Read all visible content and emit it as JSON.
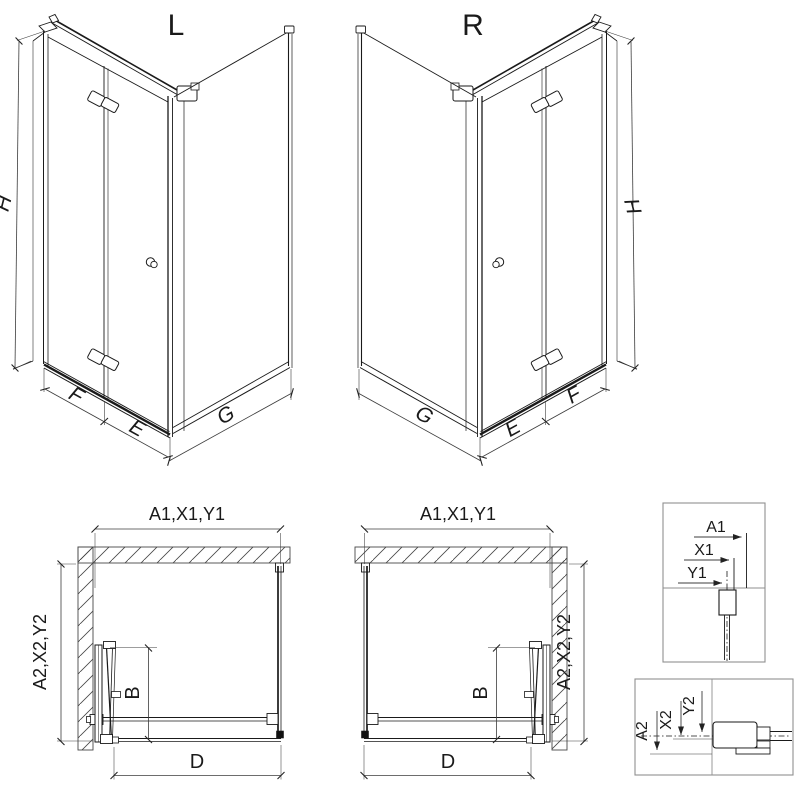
{
  "figures": {
    "iso_left": {
      "title": "L",
      "dim_height": "H",
      "dim_door_wall_segment": "F",
      "dim_door_corner_segment": "E",
      "dim_side_panel": "G"
    },
    "iso_right": {
      "title": "R",
      "dim_height": "H",
      "dim_door_wall_segment": "F",
      "dim_door_corner_segment": "E",
      "dim_side_panel": "G"
    },
    "plan_left": {
      "dim_top_width": "A1,X1,Y1",
      "dim_side_depth": "A2,X2,Y2",
      "dim_door_projection": "B",
      "dim_entry_width": "D"
    },
    "plan_right": {
      "dim_top_width": "A1,X1,Y1",
      "dim_side_depth": "A2,X2,Y2",
      "dim_door_projection": "B",
      "dim_entry_width": "D"
    },
    "detail_top": {
      "dim_a": "A1",
      "dim_x": "X1",
      "dim_y": "Y1"
    },
    "detail_bottom": {
      "dim_a": "A2",
      "dim_x": "X2",
      "dim_y": "Y2"
    }
  },
  "colors": {
    "line": "#1a1a1a",
    "dimension_line": "#3c3c3c",
    "hatch": "#474747",
    "detail_frame": "#8f8f8f",
    "background": "#ffffff"
  }
}
